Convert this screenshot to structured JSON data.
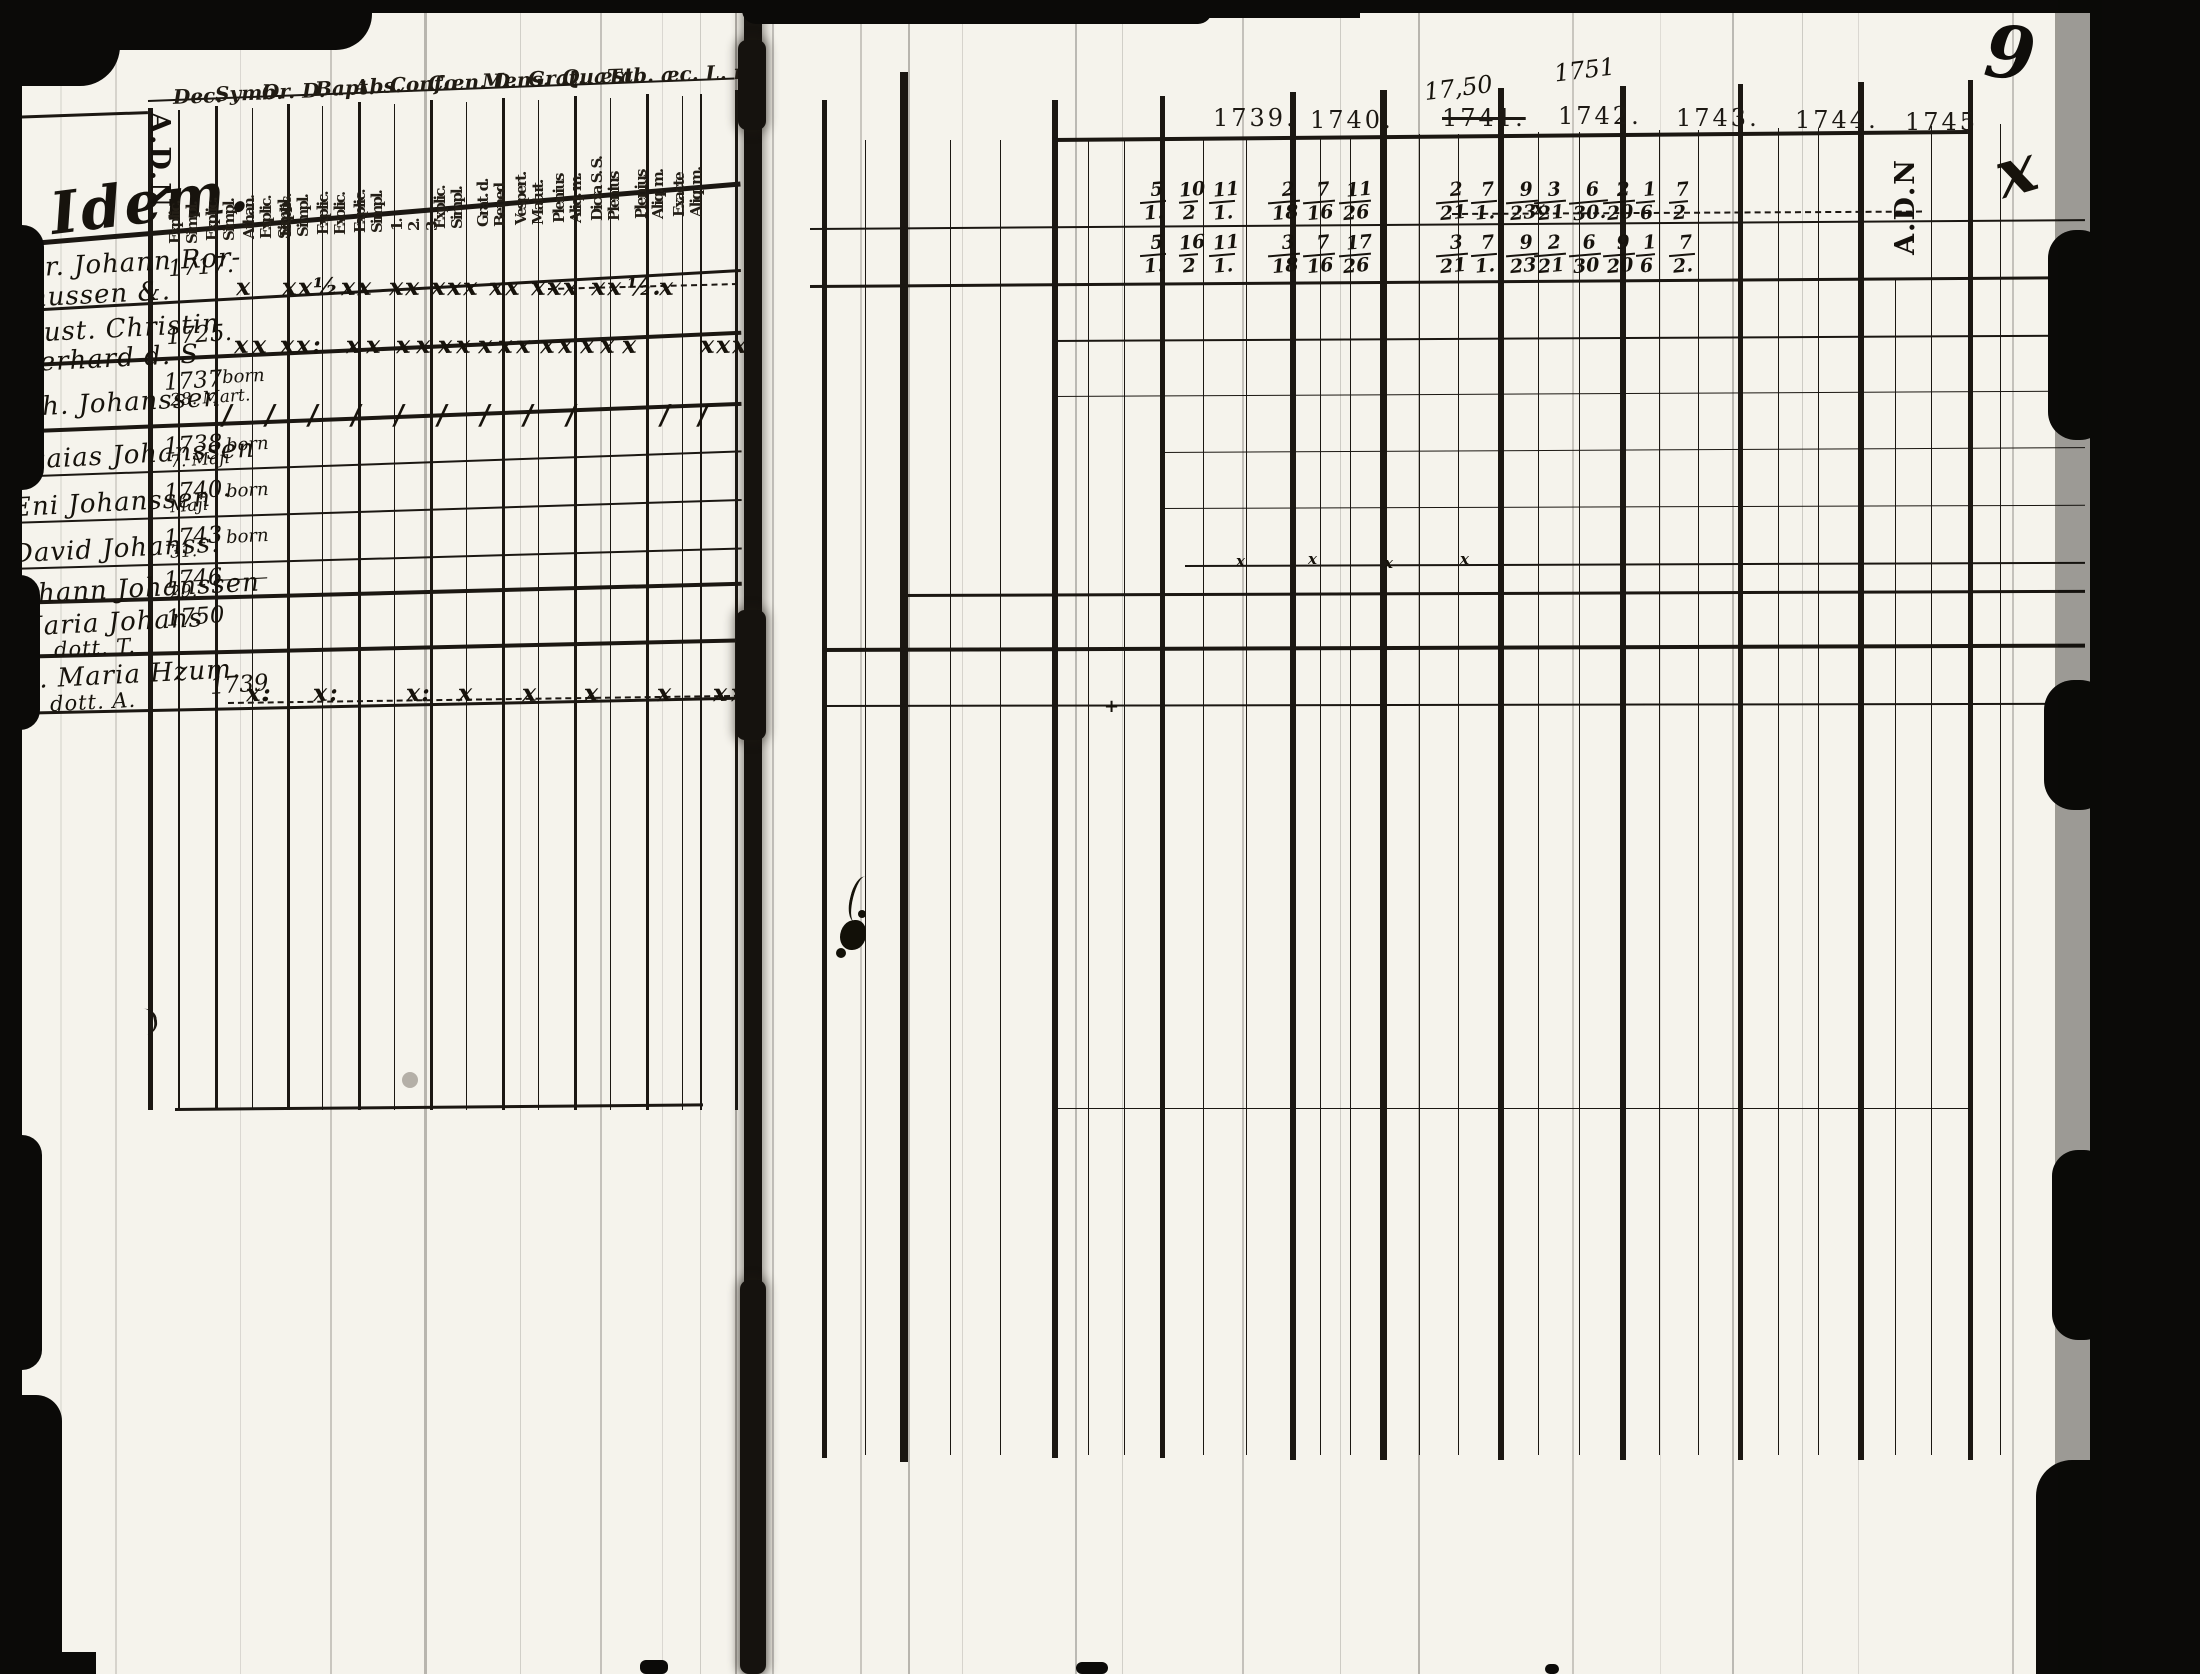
{
  "scan": {
    "left_page": {
      "page_number": "8.",
      "margin_heading_script": "Idem.",
      "name_column_header_vertical": "A.D.N",
      "header_abbreviations": [
        "Dec.",
        "Symb.",
        "Or. D.",
        "Bapt.",
        "Abs.",
        "Conf.",
        "Cœn. D.",
        "Mens.",
        "Grat.",
        "Quæst.",
        "Tab. æc. L. n."
      ],
      "subcolumn_labels_vertical": [
        [
          "Explic.",
          "Simpl."
        ],
        [
          "Explic.",
          "Simpl."
        ],
        [
          "Athan.",
          "Explic.",
          "Simpl."
        ],
        [
          "Explic.",
          "Simpl."
        ],
        [
          "Explic.",
          "Exolic."
        ],
        [
          "Explic.",
          "Simpl."
        ],
        [
          "1.",
          "2.",
          "3."
        ],
        [
          "Explic.",
          "Simpl."
        ],
        [
          "Grat. d.",
          "Bened."
        ],
        [
          "Vespert.",
          "Matut."
        ],
        [
          "Plenius",
          "Aliq. m."
        ],
        [
          "Dicta S. S.",
          "Plenius"
        ],
        [
          "Plenius",
          "Aliq. m."
        ],
        [
          "Exacte",
          "Aliq. m."
        ]
      ],
      "rows": [
        {
          "name_lines": [
            "Sr. Johann Ror-",
            "mussen &."
          ],
          "year_lines": [
            "1717."
          ],
          "note": "",
          "marks": [
            "x",
            "x",
            "x",
            "½",
            "x",
            "x",
            "x",
            "x",
            "x",
            "x",
            "x",
            "x",
            "x",
            "x",
            "x",
            "x",
            "x",
            "x",
            "½.",
            "x"
          ]
        },
        {
          "name_lines": [
            "Hust. Christin",
            "Gerhard d. S"
          ],
          "year_lines": [
            "1725."
          ],
          "note": "",
          "marks": [
            "x",
            "x",
            "x",
            "x",
            ":",
            "x",
            "x",
            "x",
            "x",
            "x",
            "x",
            "x",
            "x",
            "x",
            "x",
            "x",
            "x",
            "x",
            "x",
            "x",
            "x",
            "x"
          ]
        },
        {
          "name_lines": [
            "Joh. Johanssen"
          ],
          "year_lines": [
            "1737",
            "28. Mart."
          ],
          "note": "born",
          "marks": [
            "/",
            "/",
            "/",
            "/",
            "/",
            "/",
            "/",
            "/",
            "/",
            "/",
            "/"
          ]
        },
        {
          "name_lines": [
            "Esaias Johanssen"
          ],
          "year_lines": [
            "1738",
            "7. Maji"
          ],
          "note": "born",
          "marks": []
        },
        {
          "name_lines": [
            "Eni Johanssen"
          ],
          "year_lines": [
            "1740.",
            "Maji"
          ],
          "note": "born",
          "marks": []
        },
        {
          "name_lines": [
            "David Johanss."
          ],
          "year_lines": [
            "1743",
            "31."
          ],
          "note": "born",
          "marks": []
        },
        {
          "name_lines": [
            "Johann Johanssen"
          ],
          "year_lines": [
            "1746",
            "29."
          ],
          "note": "———",
          "marks": []
        },
        {
          "name_lines": [
            "Maria Johans",
            "dott. T."
          ],
          "year_lines": [
            "1750"
          ],
          "note": "",
          "marks": []
        },
        {
          "name_lines": [
            "fe. Maria Hzum.",
            "dott. A."
          ],
          "year_lines": [
            "1739"
          ],
          "note": "",
          "marks": [
            "x.",
            ":",
            "x",
            ":",
            "x",
            ":",
            "x",
            "x",
            "x",
            "x",
            "x",
            "x",
            "x"
          ]
        }
      ]
    },
    "right_page": {
      "page_number": "9",
      "edge_column_header_vertical": "A.D.N",
      "year_headers": [
        {
          "label": "1739."
        },
        {
          "label": "1740."
        },
        {
          "label": "1741.",
          "struck": true,
          "handwritten_above": "17,50"
        },
        {
          "label": "1742.",
          "handwritten_above": "1751"
        },
        {
          "label": "1743."
        },
        {
          "label": "1744."
        },
        {
          "label": "1745"
        }
      ],
      "attendance_fraction_rows": [
        {
          "fractions": [
            [
              "5",
              "1."
            ],
            [
              "10",
              "2"
            ],
            [
              "11",
              "1."
            ],
            [
              "2",
              "18"
            ],
            [
              "7",
              "16"
            ],
            [
              "11",
              "26"
            ],
            [
              "2",
              "21"
            ],
            [
              "7",
              "1."
            ],
            [
              "9",
              "23"
            ],
            [
              "3",
              "21"
            ],
            [
              "6",
              "30."
            ],
            [
              "2",
              "20"
            ],
            [
              "1",
              "6"
            ],
            [
              "7",
              "2"
            ]
          ]
        },
        {
          "fractions": [
            [
              "5",
              "1."
            ],
            [
              "16",
              "2"
            ],
            [
              "11",
              "1."
            ],
            [
              "3",
              "18"
            ],
            [
              "7",
              "16"
            ],
            [
              "17",
              "26"
            ],
            [
              "3",
              "21"
            ],
            [
              "7",
              "1."
            ],
            [
              "9",
              "23"
            ],
            [
              "2",
              "21"
            ],
            [
              "6",
              "30"
            ],
            [
              "9",
              "20"
            ],
            [
              "1",
              "6"
            ],
            [
              "7",
              "2."
            ]
          ]
        }
      ],
      "stray_marks": [
        "x",
        "x",
        "x",
        "x",
        "x",
        "+",
        "x"
      ]
    }
  }
}
